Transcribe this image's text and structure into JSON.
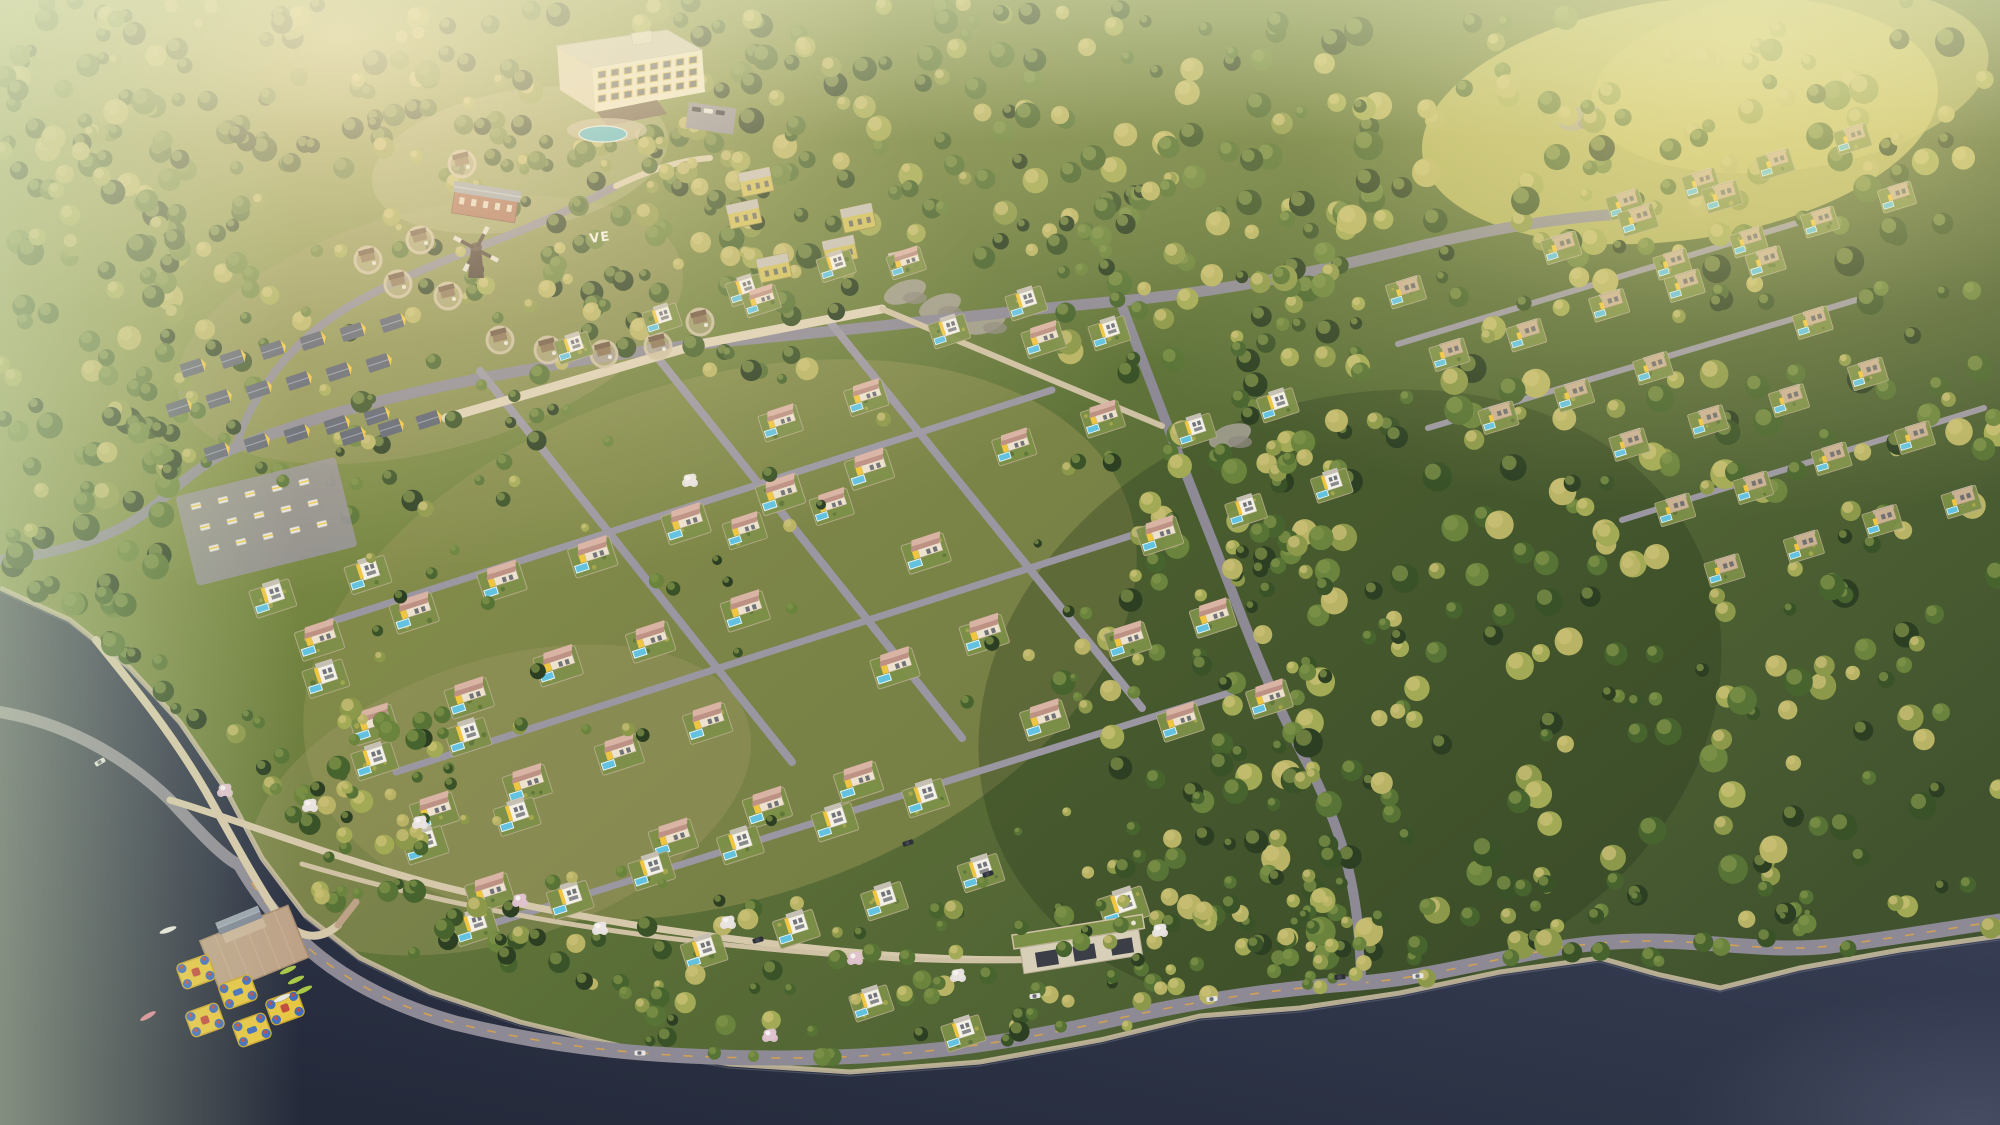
{
  "scene": {
    "title": "Aerial rendering of a lakeside hillside resort village",
    "sign": {
      "text": "VE"
    },
    "seed": 1337,
    "colors": {
      "terrain_stops": [
        "#99a259",
        "#7d8c44",
        "#5e7239",
        "#41532e"
      ],
      "terrain_light": "#8f9152",
      "terrain_light2": "#a39c66",
      "meadow_gold": "#c9c36a",
      "water_stops": [
        "#4a5168",
        "#343b50",
        "#242a3a"
      ],
      "shore_sand": "#cdbfa2",
      "road_asphalt": "#8d8a95",
      "road_asphalt_light": "#9b97a2",
      "road_line": "#d8a24a",
      "path_tan": "#d6c9ab",
      "wall_stone": "#cfc1a3",
      "wall_bright": "#ddd1b5",
      "forest_green": [
        "#2c3f23",
        "#3a5228",
        "#48642e",
        "#577335",
        "#6b843d"
      ],
      "forest_gold": [
        "#8c984a",
        "#a3aa55",
        "#b9b465"
      ],
      "tree_hi_green": "#7f934a",
      "tree_hi_gold": "#cbc077",
      "blossom_white": "#eae4e2",
      "blossom_pink": "#dfc3cf",
      "villa_cream": "#ece2cd",
      "villa_white": "#f3f0e7",
      "villa_stone": "#c9b193",
      "villa_stroke": "#b9a98e",
      "accent_yellow": "#f0c640",
      "roof_salmon_light": "#d9b3a4",
      "roof_salmon_dark": "#bd9184",
      "roof_flat": "#c6c0b4",
      "roof_stone_top": "#d7cec0",
      "window_dark": "#5b5e68",
      "pool_blue": "#62c2e0",
      "pool_rim": "#e8f4f8",
      "lawn": "#7d9048",
      "hotel_wall": "#f0e9d0",
      "hotel_wall_shade": "#ddd3b9",
      "hotel_roof": "#d2ccbf",
      "hotel_window_frame": "#e5c460",
      "canopy_brown": "#6b5847",
      "brick": "#a96c56",
      "lodge_roof": "#99a0ac",
      "roof_gray_blue": "#5a6070",
      "ridge_light": "#8d94a8",
      "windmill_dark": "#473931",
      "blade_light": "#e2ded4",
      "pier_wood": "#bda288",
      "boathouse_wall": "#cbb59a",
      "boathouse_roof": "#7e8696",
      "boathouse_roof_light": "#9aa2ae",
      "inflatable_yellow": "#e7c642",
      "inflatable_blue": "#3e6cbd",
      "inflatable_red": "#c24a3e",
      "kayak_green": "#a9c84a",
      "kayak_pink": "#d98296",
      "kayak_white": "#e9e8e2",
      "yellow_block": "#cfc05e",
      "rock_gray": "#a8a296",
      "rock_dark": "#8f897e",
      "car_dark": "#2e3138",
      "car_white": "#e6e6e4",
      "amenity_wall": "#d8cfb8",
      "amenity_opening": "#3b3e46",
      "sign_white": "#f2efe8"
    },
    "lake": {
      "shoreline": [
        [
          0,
          588
        ],
        [
          70,
          620
        ],
        [
          130,
          668
        ],
        [
          180,
          722
        ],
        [
          225,
          788
        ],
        [
          262,
          858
        ],
        [
          305,
          915
        ],
        [
          360,
          958
        ],
        [
          430,
          992
        ],
        [
          520,
          1022
        ],
        [
          620,
          1046
        ],
        [
          730,
          1064
        ],
        [
          850,
          1072
        ],
        [
          980,
          1062
        ],
        [
          1100,
          1040
        ],
        [
          1200,
          1016
        ],
        [
          1300,
          1008
        ],
        [
          1400,
          993
        ],
        [
          1500,
          972
        ],
        [
          1600,
          958
        ],
        [
          1660,
          975
        ],
        [
          1720,
          988
        ],
        [
          1800,
          968
        ],
        [
          1900,
          950
        ],
        [
          2000,
          936
        ]
      ]
    },
    "roads": [
      {
        "d": "M 240,864 C 290,950 360,996 455,1023 C 560,1049 660,1058 780,1058 C 900,1058 1000,1046 1120,1018 C 1220,996 1290,988 1360,983 C 1440,977 1520,950 1600,943 C 1690,935 1760,954 1830,946 C 1890,939 1950,928 2000,921",
        "w": 15,
        "c": "road_asphalt",
        "line": true
      },
      {
        "d": "M 0,712 C 60,722 120,752 170,800 C 205,838 228,862 242,866",
        "w": 12,
        "c": "road_asphalt"
      },
      {
        "d": "M 0,560 C 70,552 120,535 155,505 C 190,475 205,462 235,448",
        "w": 10,
        "c": "road_asphalt"
      },
      {
        "d": "M 235,448 C 330,410 425,388 520,371 C 615,354 680,345 762,338 C 900,325 1000,312 1120,301 C 1240,290 1330,268 1420,246 C 1500,227 1560,218 1620,214",
        "w": 11,
        "c": "road_asphalt"
      },
      {
        "d": "M 235,448 C 255,385 300,332 362,299 C 420,268 472,250 520,231 C 556,216 588,201 616,186",
        "w": 8,
        "c": "road_asphalt"
      },
      {
        "d": "M 1120,301 C 1150,380 1180,460 1212,540 C 1243,620 1272,700 1312,772 C 1342,832 1360,890 1361,982",
        "w": 10,
        "c": "road_asphalt"
      },
      {
        "d": "M 480,371 L 792,762",
        "w": 8,
        "c": "road_asphalt_light"
      },
      {
        "d": "M 650,348 L 962,738",
        "w": 8,
        "c": "road_asphalt_light"
      },
      {
        "d": "M 830,322 L 1142,708",
        "w": 8,
        "c": "road_asphalt_light"
      },
      {
        "d": "M 330,622 L 1052,390",
        "w": 7,
        "c": "road_asphalt_light"
      },
      {
        "d": "M 396,772 L 1142,532",
        "w": 7,
        "c": "road_asphalt_light"
      },
      {
        "d": "M 472,930 L 1232,692",
        "w": 7,
        "c": "road_asphalt_light"
      },
      {
        "d": "M 170,800 C 250,824 340,860 440,886 C 570,918 700,937 840,951 C 950,962 1040,962 1120,955",
        "w": 7,
        "c": "path_tan"
      },
      {
        "d": "M 96,640 C 130,682 170,730 205,790 C 232,838 255,880 276,912 C 295,938 318,943 338,925",
        "w": 8,
        "c": "path_tan"
      },
      {
        "d": "M 446,418 L 700,344 L 882,309",
        "w": 9,
        "c": "wall_bright"
      },
      {
        "d": "M 882,309 L 1162,426",
        "w": 6,
        "c": "wall_stone"
      },
      {
        "d": "M 302,864 C 500,922 700,947 900,959 C 1000,963 1080,960 1132,951",
        "w": 5,
        "c": "wall_stone"
      },
      {
        "d": "M 1398,344 L 1800,222",
        "w": 6,
        "c": "road_asphalt_light"
      },
      {
        "d": "M 1428,428 L 1856,300",
        "w": 6,
        "c": "road_asphalt_light"
      },
      {
        "d": "M 1622,520 L 1984,408",
        "w": 6,
        "c": "road_asphalt_light"
      },
      {
        "d": "M 616,186 C 650,170 680,160 710,158",
        "w": 6,
        "c": "path_tan"
      },
      {
        "d": "M 338,925 L 356,902",
        "w": 7,
        "c": "pier_wood"
      }
    ],
    "forest_regions": [
      {
        "x": 1230,
        "y": 0,
        "w": 770,
        "h": 1050,
        "count": 430,
        "rmin": 6,
        "rmax": 15,
        "gold": 0.4,
        "layer": "bg"
      },
      {
        "x": 640,
        "y": 0,
        "w": 620,
        "h": 260,
        "count": 150,
        "rmin": 6,
        "rmax": 13,
        "gold": 0.3,
        "layer": "bg"
      },
      {
        "x": 0,
        "y": 0,
        "w": 660,
        "h": 170,
        "count": 130,
        "rmin": 6,
        "rmax": 13,
        "gold": 0.25,
        "layer": "bg"
      },
      {
        "x": 0,
        "y": 150,
        "w": 190,
        "h": 560,
        "count": 120,
        "rmin": 7,
        "rmax": 14,
        "gold": 0.18,
        "layer": "bg"
      },
      {
        "x": 150,
        "y": 200,
        "w": 420,
        "h": 320,
        "count": 70,
        "rmin": 5,
        "rmax": 11,
        "gold": 0.25,
        "layer": "bg"
      },
      {
        "x": 430,
        "y": 120,
        "w": 420,
        "h": 260,
        "count": 85,
        "rmin": 5,
        "rmax": 12,
        "gold": 0.3,
        "layer": "bg"
      },
      {
        "x": 1060,
        "y": 250,
        "w": 280,
        "h": 700,
        "count": 130,
        "rmin": 6,
        "rmax": 13,
        "gold": 0.35,
        "layer": "bg"
      },
      {
        "x": 1300,
        "y": 880,
        "w": 700,
        "h": 160,
        "count": 80,
        "rmin": 5,
        "rmax": 11,
        "gold": 0.35,
        "layer": "bg"
      },
      {
        "x": 130,
        "y": 700,
        "w": 330,
        "h": 330,
        "count": 90,
        "rmin": 5,
        "rmax": 12,
        "gold": 0.3,
        "layer": "fg"
      },
      {
        "x": 420,
        "y": 900,
        "w": 720,
        "h": 160,
        "count": 90,
        "rmin": 5,
        "rmax": 11,
        "gold": 0.3,
        "layer": "fg"
      },
      {
        "x": 1100,
        "y": 900,
        "w": 260,
        "h": 130,
        "count": 40,
        "rmin": 5,
        "rmax": 10,
        "gold": 0.35,
        "layer": "fg"
      },
      {
        "x": 250,
        "y": 380,
        "w": 850,
        "h": 520,
        "count": 60,
        "rmin": 4,
        "rmax": 8,
        "gold": 0.35,
        "layer": "fg"
      }
    ],
    "clusters": [
      {
        "name": "upper-terrace-row",
        "style": "cube",
        "origin": [
          575,
          345
        ],
        "cols": 4,
        "rows": 1,
        "colStep": [
          86,
          -27
        ],
        "rowStep": [
          0,
          0
        ],
        "scale": 0.8,
        "angle": -18,
        "skip": 0
      },
      {
        "name": "upper-center",
        "style": "pitched",
        "origin": [
          688,
          452
        ],
        "cols": 5,
        "rows": 2,
        "colStep": [
          89,
          -28
        ],
        "rowStep": [
          55,
          80
        ],
        "scale": 0.9,
        "angle": -18,
        "skip": 0.08
      },
      {
        "name": "central-field",
        "style": "pitched",
        "origin": [
          318,
          640
        ],
        "cols": 7,
        "rows": 4,
        "colStep": [
          92,
          -29
        ],
        "rowStep": [
          57,
          85
        ],
        "scale": 1.0,
        "angle": -18,
        "skip": 0.1
      },
      {
        "name": "left-shore-column",
        "style": "cube",
        "origin": [
          272,
          598
        ],
        "cols": 2,
        "rows": 5,
        "colStep": [
          94,
          -26
        ],
        "rowStep": [
          50,
          82
        ],
        "scale": 0.95,
        "angle": -18,
        "skip": 0.1
      },
      {
        "name": "bottom-strip",
        "style": "cube",
        "origin": [
          648,
          872
        ],
        "cols": 4,
        "rows": 2,
        "colStep": [
          92,
          -26
        ],
        "rowStep": [
          54,
          80
        ],
        "scale": 0.95,
        "angle": -18,
        "skip": 0.12
      },
      {
        "name": "east-of-field",
        "style": "pitched",
        "origin": [
          1068,
          560
        ],
        "cols": 2,
        "rows": 3,
        "colStep": [
          90,
          -28
        ],
        "rowStep": [
          56,
          82
        ],
        "scale": 0.95,
        "angle": -18,
        "skip": 0.15
      },
      {
        "name": "mid-right",
        "style": "cube",
        "origin": [
          1192,
          432
        ],
        "cols": 2,
        "rows": 2,
        "colStep": [
          86,
          -27
        ],
        "rowStep": [
          52,
          78
        ],
        "scale": 0.85,
        "angle": -18,
        "skip": 0
      },
      {
        "name": "upper-right-a",
        "style": "stone",
        "origin": [
          1402,
          292
        ],
        "cols": 5,
        "rows": 3,
        "colStep": [
          79,
          -24
        ],
        "rowStep": [
          47,
          63
        ],
        "scale": 0.82,
        "angle": -17,
        "skip": 0.1
      },
      {
        "name": "top-right-b",
        "style": "stone",
        "origin": [
          1625,
          206
        ],
        "cols": 4,
        "rows": 2,
        "colStep": [
          76,
          -22
        ],
        "rowStep": [
          44,
          58
        ],
        "scale": 0.78,
        "angle": -17,
        "skip": 0.1
      },
      {
        "name": "east-ridge",
        "style": "stone",
        "origin": [
          1628,
          446
        ],
        "cols": 4,
        "rows": 3,
        "colStep": [
          79,
          -24
        ],
        "rowStep": [
          47,
          62
        ],
        "scale": 0.82,
        "angle": -17,
        "skip": 0.12
      }
    ],
    "single_villas": [
      {
        "style": "cube",
        "x": 948,
        "y": 330,
        "scale": 0.85
      },
      {
        "style": "cube",
        "x": 1025,
        "y": 302,
        "scale": 0.85
      },
      {
        "style": "cube",
        "x": 1108,
        "y": 332,
        "scale": 0.85
      },
      {
        "style": "pitched",
        "x": 905,
        "y": 262,
        "scale": 0.8
      },
      {
        "style": "cube",
        "x": 1122,
        "y": 906,
        "scale": 1.05
      },
      {
        "style": "pitched",
        "x": 760,
        "y": 300,
        "scale": 0.8
      },
      {
        "style": "cube",
        "x": 870,
        "y": 1002,
        "scale": 0.9
      },
      {
        "style": "cube",
        "x": 962,
        "y": 1032,
        "scale": 0.9
      }
    ],
    "glamping_rows": [
      {
        "origin": [
          192,
          368
        ],
        "count": 6,
        "step": [
          40,
          -9
        ]
      },
      {
        "origin": [
          178,
          408
        ],
        "count": 6,
        "step": [
          40,
          -9
        ]
      },
      {
        "origin": [
          216,
          452
        ],
        "count": 5,
        "step": [
          40,
          -9
        ]
      },
      {
        "origin": [
          352,
          436
        ],
        "count": 3,
        "step": [
          38,
          -8
        ]
      }
    ],
    "trailer_park": {
      "origin": [
        196,
        506
      ],
      "cols": 5,
      "rows": 3,
      "colStep": [
        27,
        -6
      ],
      "rowStep": [
        9,
        21
      ]
    },
    "cottages": [
      [
        398,
        282
      ],
      [
        448,
        294
      ],
      [
        500,
        338
      ],
      [
        548,
        348
      ],
      [
        604,
        352
      ],
      [
        658,
        344
      ],
      [
        368,
        258
      ],
      [
        420,
        238
      ],
      [
        462,
        162
      ],
      [
        700,
        320
      ]
    ],
    "yellow_blocks": [
      [
        756,
        182
      ],
      [
        744,
        214
      ],
      [
        774,
        268
      ],
      [
        858,
        218
      ],
      [
        840,
        250
      ],
      [
        906,
        262
      ]
    ],
    "rocks": [
      [
        940,
        306
      ],
      [
        985,
        322
      ],
      [
        1230,
        436
      ],
      [
        1580,
        118
      ],
      [
        905,
        292
      ]
    ],
    "blossoms": [
      [
        225,
        790
      ],
      [
        310,
        805
      ],
      [
        420,
        822
      ],
      [
        520,
        900
      ],
      [
        600,
        928
      ],
      [
        728,
        922
      ],
      [
        855,
        958
      ],
      [
        958,
        975
      ],
      [
        690,
        480
      ],
      [
        770,
        1035
      ],
      [
        1160,
        930
      ]
    ],
    "cars": [
      [
        100,
        762,
        -30,
        "car_white"
      ],
      [
        1035,
        996,
        -8,
        "car_white"
      ],
      [
        988,
        874,
        -18,
        "car_dark"
      ],
      [
        908,
        843,
        -18,
        "car_dark"
      ],
      [
        758,
        940,
        -15,
        "car_dark"
      ],
      [
        1340,
        977,
        -5,
        "car_dark"
      ],
      [
        1418,
        976,
        -5,
        "car_white"
      ],
      [
        1212,
        999,
        -8,
        "car_white"
      ],
      [
        640,
        1053,
        0,
        "car_white"
      ]
    ],
    "hotel": {
      "x": 537,
      "y": 28
    },
    "lodge": {
      "x": 485,
      "y": 205,
      "angle": 9
    },
    "windmill": {
      "x": 476,
      "y": 248
    },
    "pier": {
      "x": 252,
      "y": 950,
      "angle": -22
    },
    "amenity": {
      "x": 1020,
      "y": 948,
      "angle": -9
    },
    "inflatables": [
      [
        196,
        972
      ],
      [
        238,
        992
      ],
      [
        205,
        1020
      ],
      [
        252,
        1030
      ],
      [
        285,
        1008
      ]
    ],
    "kayaks": [
      [
        288,
        970,
        -25,
        "kayak_green"
      ],
      [
        296,
        980,
        -25,
        "kayak_green"
      ],
      [
        304,
        990,
        -25,
        "kayak_green"
      ],
      [
        282,
        998,
        -25,
        "kayak_white"
      ],
      [
        148,
        1016,
        -30,
        "kayak_pink"
      ],
      [
        168,
        930,
        -20,
        "kayak_white"
      ]
    ],
    "sign_pos": {
      "x": 590,
      "y": 243,
      "angle": -8
    }
  }
}
